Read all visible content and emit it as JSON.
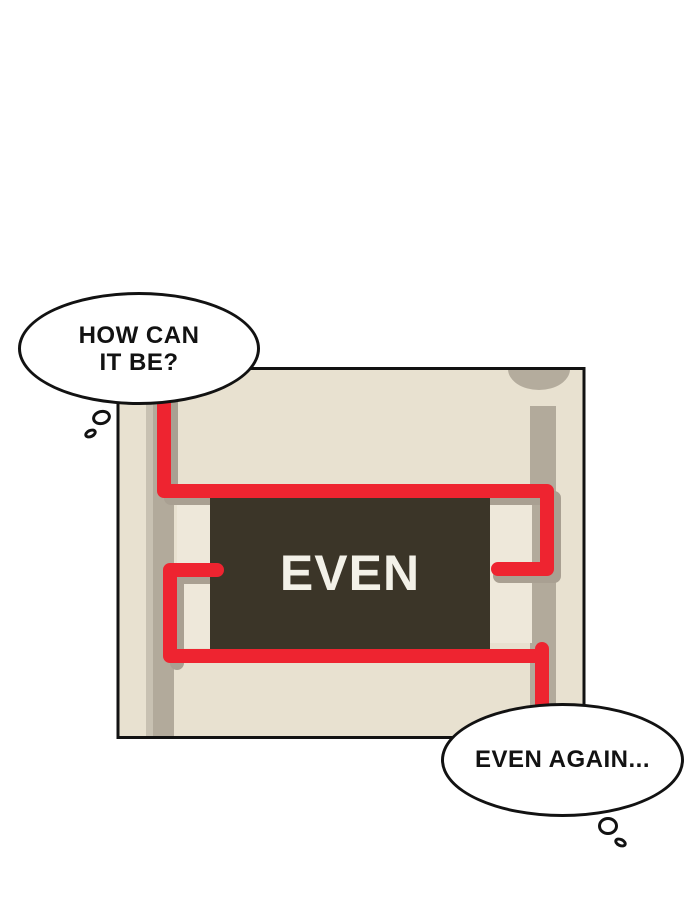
{
  "scene": {
    "background_color": "#ffffff",
    "outline_color": "#121212"
  },
  "panel": {
    "background_color": "#e8e1d0",
    "border_color": "#121212",
    "groove_color": "#b2aa9b",
    "groove_highlight_color": "#c8c1b2",
    "corner_notch_color": "#b4ac9d",
    "inset_color": "#eee8da",
    "shadow_color": "#a9a092",
    "cord_color": "#ee2430",
    "label_box": {
      "text": "EVEN",
      "background_color": "#3b3528",
      "text_color": "#f3f1e8"
    }
  },
  "bubbles": {
    "top_left": {
      "line1": "HOW CAN",
      "line2": "IT BE?"
    },
    "bottom_right": {
      "text": "EVEN AGAIN..."
    }
  }
}
